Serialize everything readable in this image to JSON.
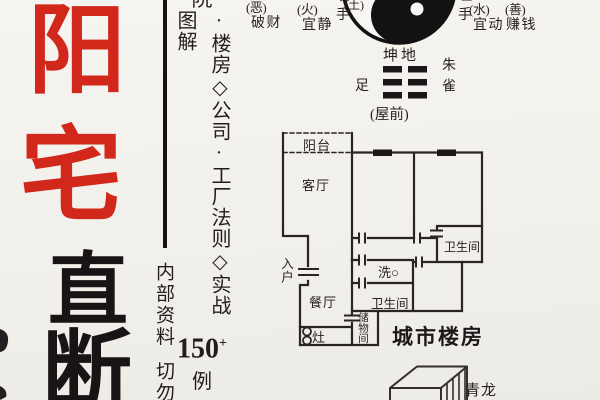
{
  "page": {
    "background": "#f2f0eb",
    "ink": "#181415",
    "red": "#d2281b"
  },
  "title": {
    "red_chars": [
      "阳",
      "宅"
    ],
    "black_chars": [
      "直",
      "断"
    ]
  },
  "spine": {
    "clipped_top_char": "院",
    "vertical_text": "·楼房◇公司·工厂法则◇实战图解",
    "count": "150",
    "count_superscript": "+",
    "count_unit": "例"
  },
  "notice": {
    "line1": "内部资料",
    "line2": "切勿"
  },
  "taiji_diagram": {
    "left_annotations": [
      {
        "tag": "(恶)",
        "text": "破财"
      },
      {
        "tag": "(火)",
        "text": "宜静"
      }
    ],
    "left_hand_clipped": "右",
    "left_hand": "手",
    "element_label": "(土)",
    "right_hand_clipped": "左",
    "right_hand": "手",
    "right_annotations": [
      {
        "tag": "(水)",
        "text": "宜动"
      },
      {
        "tag": "(善)",
        "text": "赚钱"
      }
    ]
  },
  "trigram_diagram": {
    "name": "坤地",
    "left": "足",
    "right": "朱雀",
    "bottom": "(屋前)"
  },
  "floorplan": {
    "balcony": "阳台",
    "living_room": "客厅",
    "bathroom_1": "卫生间",
    "entry": "入户",
    "wash": "洗○",
    "bathroom_2": "卫生间",
    "dining_room": "餐厅",
    "stove": "灶",
    "storage": "储物间",
    "caption": "城市楼房"
  },
  "building_block": {
    "label": "青龙"
  }
}
